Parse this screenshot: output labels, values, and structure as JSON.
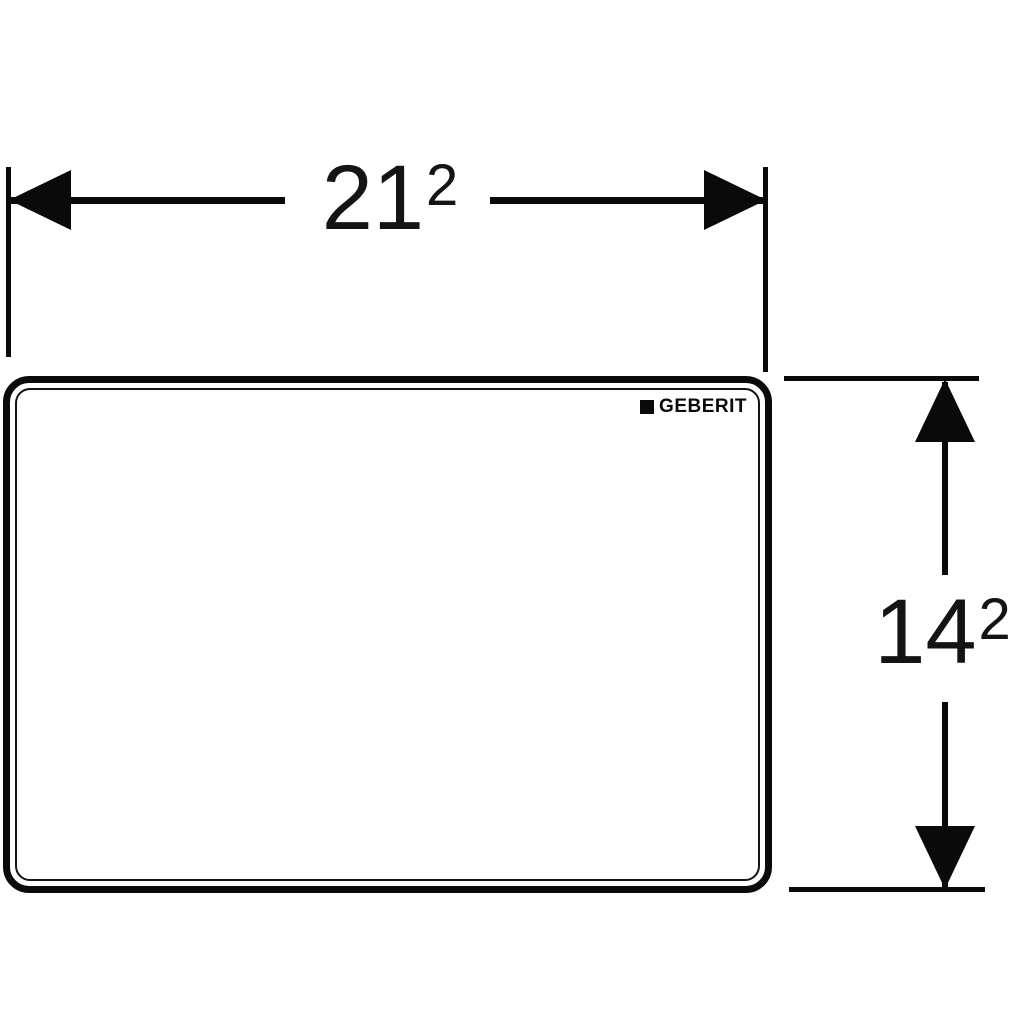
{
  "page": {
    "background_color": "#ffffff",
    "line_color": "#0a0a0a",
    "type": "technical-dimension-drawing"
  },
  "plate": {
    "brand": "GEBERIT",
    "fill_color": "#ffffff"
  },
  "dimensions": {
    "width": {
      "base": "21",
      "sup": "2"
    },
    "height": {
      "base": "14",
      "sup": "2"
    }
  }
}
